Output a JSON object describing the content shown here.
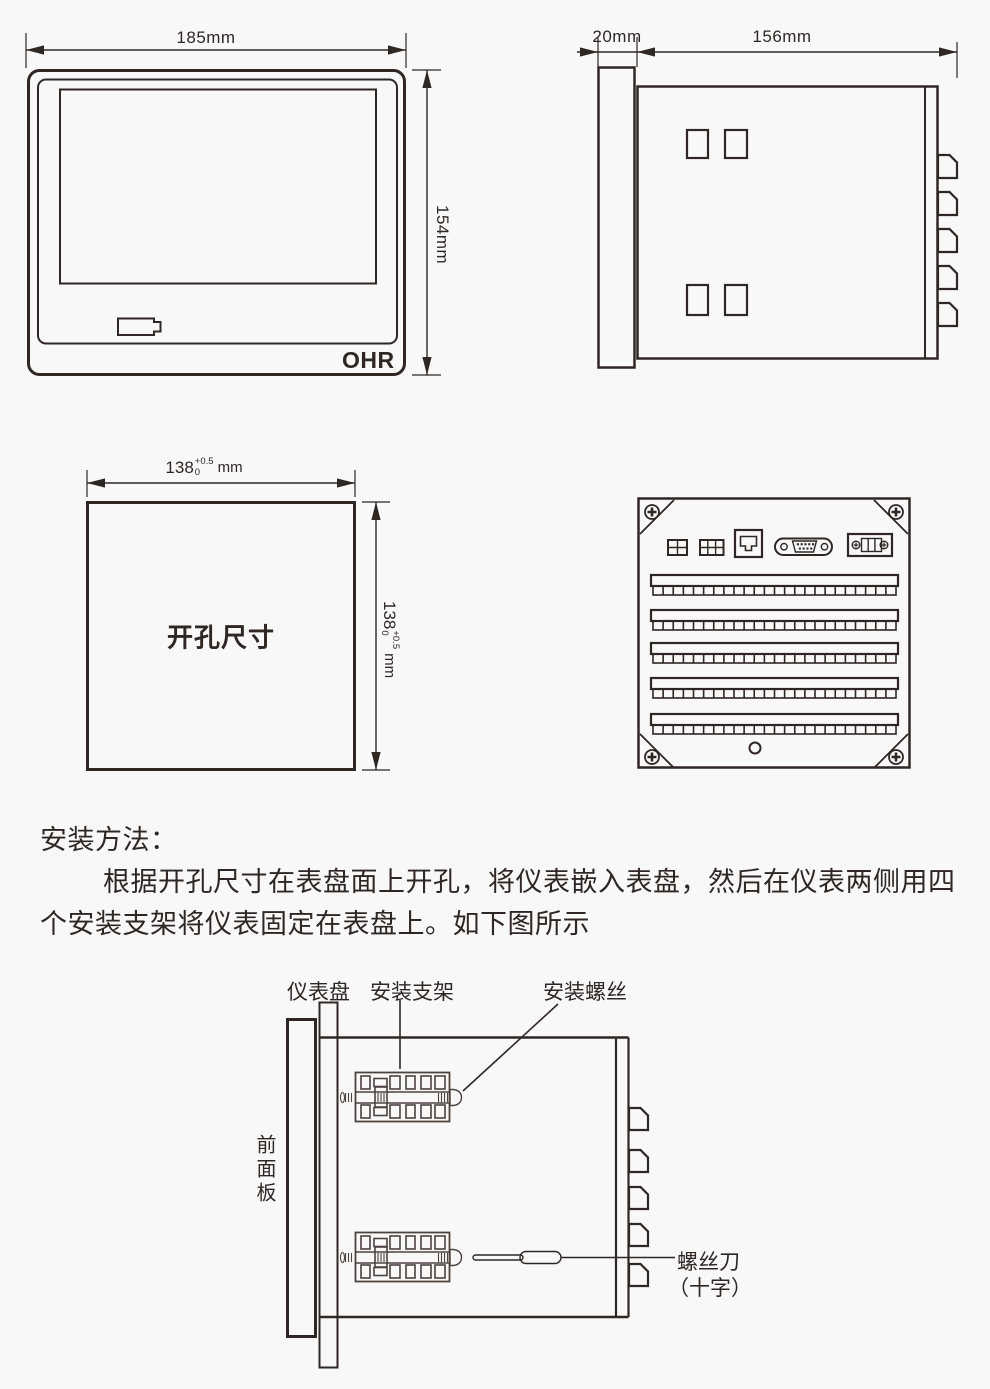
{
  "colors": {
    "ink": "#2f2724",
    "bracket_ink": "#4c433f",
    "panel_fill": "#d9d9d9",
    "handle_fill": "#c9c9c9",
    "background": "#f8f8f8"
  },
  "front_view": {
    "width_label": "185mm",
    "height_label": "154mm",
    "brand": "OHR"
  },
  "side_view": {
    "depth_label": "20mm",
    "length_label": "156mm"
  },
  "cutout_view": {
    "title": "开孔尺寸",
    "dim_value": "138",
    "tol_upper": "+0.5",
    "tol_lower": "0",
    "unit": "mm"
  },
  "instructions": {
    "heading": "安装方法：",
    "line1": "根据开孔尺寸在表盘面上开孔，将仪表嵌入表盘，然后在仪表两侧用四",
    "line2": "个安装支架将仪表固定在表盘上。如下图所示"
  },
  "installation": {
    "panel_label": "仪表盘",
    "bracket_label": "安装支架",
    "screw_label": "安装螺丝",
    "front_panel_label": "前面板",
    "screwdriver_label": "螺丝刀",
    "screwdriver_type_label": "（十字）"
  }
}
